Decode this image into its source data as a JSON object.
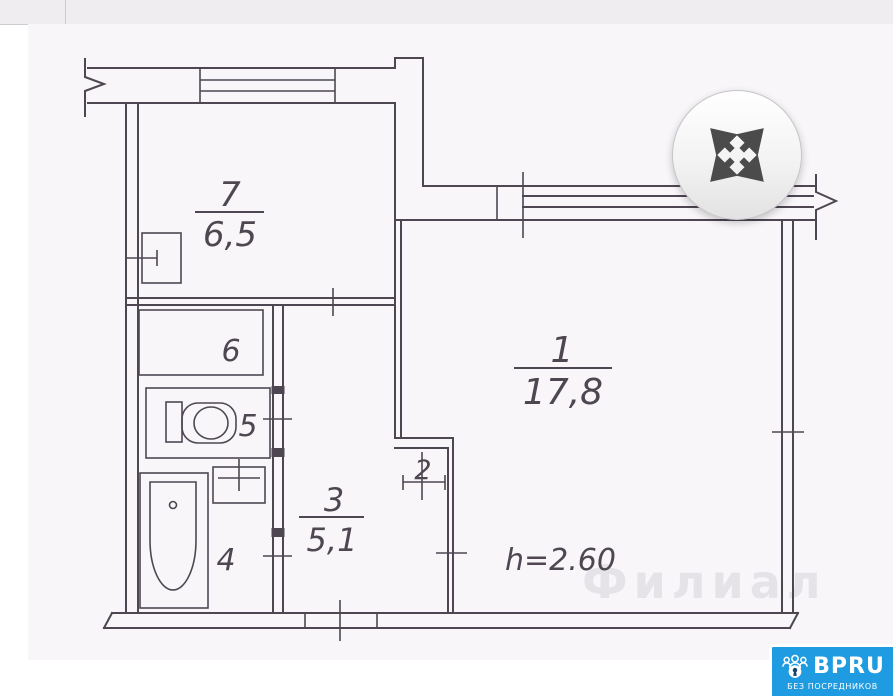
{
  "gallery": {
    "expand_button": {
      "icon": "expand-arrows"
    }
  },
  "floor_plan": {
    "rooms": [
      {
        "number": "1",
        "area": "17,8"
      },
      {
        "number": "2"
      },
      {
        "number": "3",
        "area": "5,1"
      },
      {
        "number": "4"
      },
      {
        "number": "5"
      },
      {
        "number": "6"
      },
      {
        "number": "7",
        "area": "6,5"
      }
    ],
    "ceiling_height_label": "h=2.60",
    "watermark": "Филиал",
    "line_color": "#4e4752"
  },
  "logo": {
    "brand": "BPRU",
    "tagline": "БЕЗ ПОСРЕДНИКОВ",
    "background": "#1f9ce1"
  }
}
